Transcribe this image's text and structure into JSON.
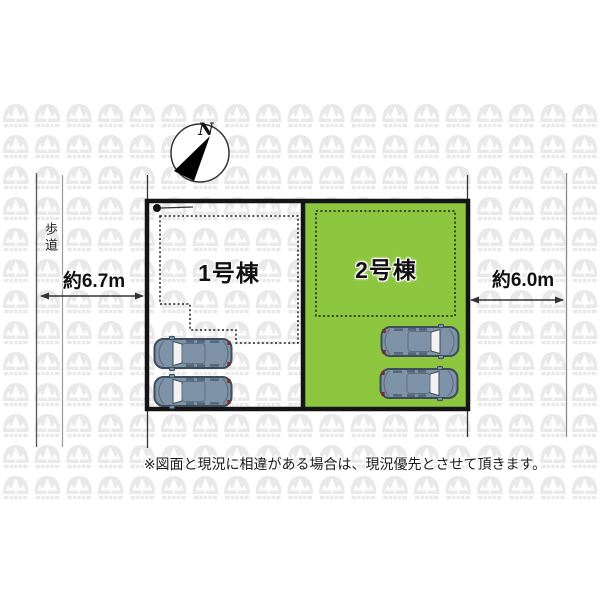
{
  "page": {
    "background": "#ffffff"
  },
  "colors": {
    "highlight_green": "#8dc63f",
    "car_body": "#7e93a7",
    "line_black": "#1a1a1a",
    "watermark_gray": "#e9e9e9"
  },
  "compass": {
    "label": "N"
  },
  "roadside": {
    "sidewalk_label": "歩道"
  },
  "dimensions": {
    "left_width": "約6.7m",
    "right_width": "約6.0m"
  },
  "plots": [
    {
      "building_label": "1号棟",
      "highlighted": false,
      "car_count": 2
    },
    {
      "building_label": "2号棟",
      "highlighted": true,
      "car_count": 2
    }
  ],
  "note": "※図面と現況に相違がある場合は、現況優先とさせて頂きます。"
}
